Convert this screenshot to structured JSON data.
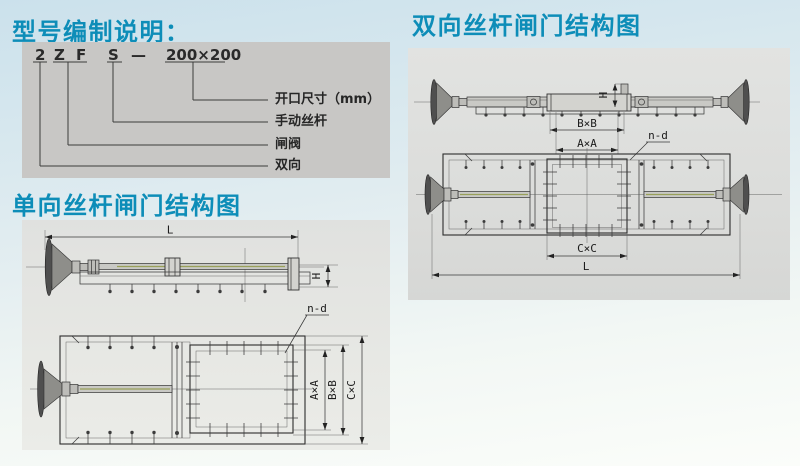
{
  "colors": {
    "title_accent": "#0d8db8",
    "model_panel_bg": "#c8c7c5",
    "drawing_panel_bg": "#e0e1df",
    "line": "#3a3a3a"
  },
  "model_section": {
    "title": "型号编制说明：",
    "code": {
      "direction": "2",
      "valve_z": "Z",
      "valve_f": "F",
      "screw": "S",
      "dash": "—",
      "size": "200×200"
    },
    "meanings": [
      {
        "text": "开口尺寸（mm）"
      },
      {
        "text": "手动丝杆"
      },
      {
        "text": "闸阀"
      },
      {
        "text": "双向"
      }
    ]
  },
  "single_diagram": {
    "title": "单向丝杆闸门结构图",
    "labels": {
      "length": "L",
      "height": "H",
      "holes": "n-d",
      "opening": "A×A",
      "frame": "B×B",
      "seat": "C×C"
    }
  },
  "double_diagram": {
    "title": "双向丝杆闸门结构图",
    "labels": {
      "length": "L",
      "height": "H",
      "holes": "n-d",
      "opening": "A×A",
      "frame": "B×B",
      "seat": "C×C"
    }
  }
}
